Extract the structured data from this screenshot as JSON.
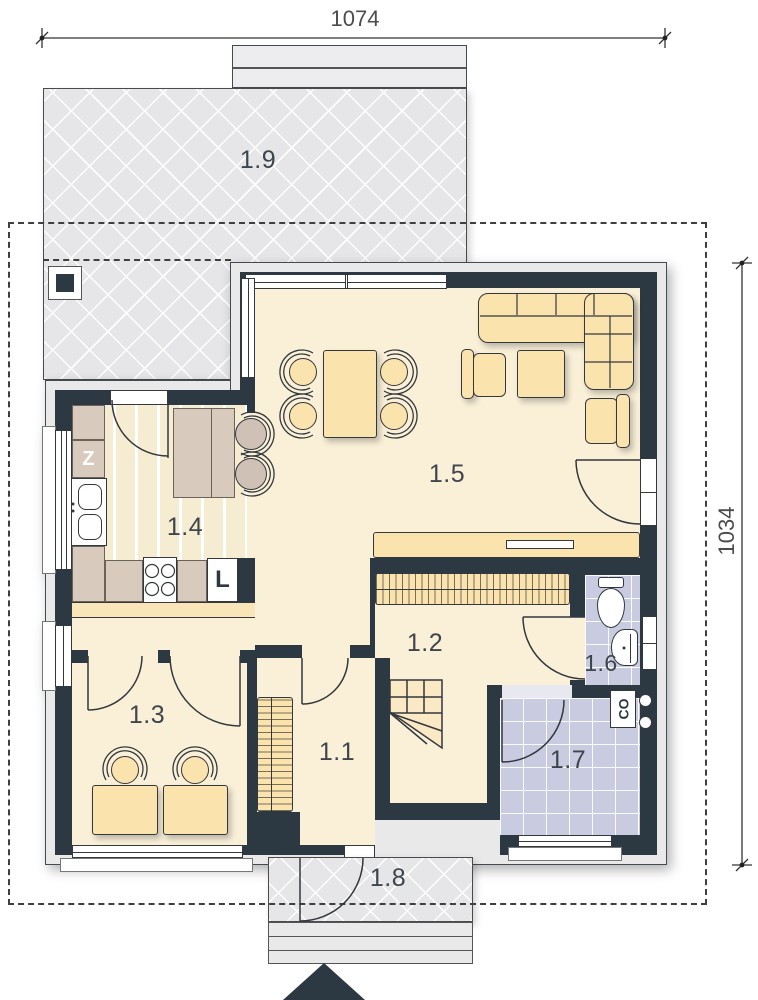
{
  "dimensions": {
    "top": "1074",
    "right": "1034"
  },
  "rooms": {
    "vestibule": {
      "label": "1.1"
    },
    "hall": {
      "label": "1.2"
    },
    "room": {
      "label": "1.3"
    },
    "kitchen": {
      "label": "1.4"
    },
    "living_room": {
      "label": "1.5"
    },
    "bathroom": {
      "label": "1.6"
    },
    "utility": {
      "label": "1.7"
    },
    "porch": {
      "label": "1.8"
    },
    "terrace": {
      "label": "1.9"
    }
  },
  "appliances": {
    "dishwasher": "Z",
    "fridge": "L",
    "boiler": "CO"
  },
  "colors": {
    "wall": "#2d3942",
    "floor_cream": "#faf0d8",
    "furniture_tan": "#fbe3ae",
    "counter_beige": "#d8cabc",
    "tile_lavender": "#c9cce0",
    "paving_gray": "#e6e6e8"
  }
}
